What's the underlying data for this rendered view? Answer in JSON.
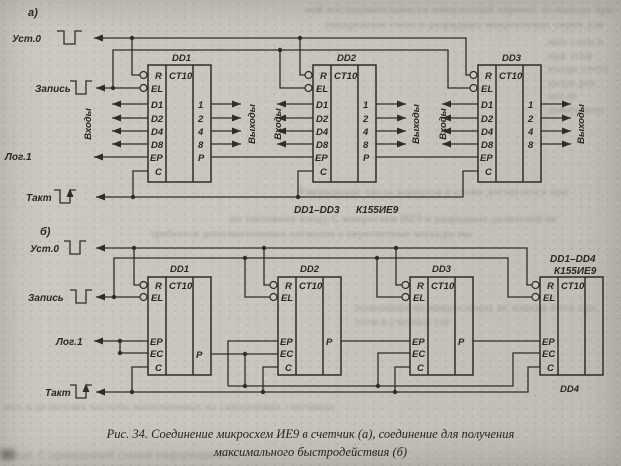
{
  "page": {
    "paper_color": "#c8c5be",
    "ink_color": "#2f2d29"
  },
  "diagram_a": {
    "label": "а)",
    "signals": {
      "set0": "Уст.0",
      "write": "Запись",
      "log1": "Лог.1",
      "clock": "Такт",
      "inputs": "Входы",
      "outputs": "Выходы"
    },
    "chips": [
      {
        "name": "DD1",
        "type": "CT10",
        "pins_left": [
          "R",
          "EL",
          "D1",
          "D2",
          "D4",
          "D8",
          "EP",
          "C"
        ],
        "pins_right": [
          "1",
          "2",
          "4",
          "8",
          "P"
        ]
      },
      {
        "name": "DD2",
        "type": "CT10",
        "pins_left": [
          "R",
          "EL",
          "D1",
          "D2",
          "D4",
          "D8",
          "EP",
          "C"
        ],
        "pins_right": [
          "1",
          "2",
          "4",
          "8",
          "P"
        ]
      },
      {
        "name": "DD3",
        "type": "CT10",
        "pins_left": [
          "R",
          "EL",
          "D1",
          "D2",
          "D4",
          "D8",
          "EP",
          "C"
        ],
        "pins_right": [
          "1",
          "2",
          "4",
          "8"
        ]
      }
    ],
    "part_label": "DD1–DD3",
    "part_number": "К155ИЕ9"
  },
  "diagram_b": {
    "label": "б)",
    "signals": {
      "set0": "Уст.0",
      "write": "Запись",
      "log1": "Лог.1",
      "clock": "Такт"
    },
    "chips": [
      {
        "name": "DD1",
        "type": "CT10",
        "pins_left": [
          "R",
          "EL",
          "EP",
          "EC",
          "C"
        ],
        "carry": "P"
      },
      {
        "name": "DD2",
        "type": "CT10",
        "pins_left": [
          "R",
          "EL",
          "EP",
          "EC",
          "C"
        ],
        "carry": "P"
      },
      {
        "name": "DD3",
        "type": "CT10",
        "pins_left": [
          "R",
          "EL",
          "EP",
          "EC",
          "C"
        ],
        "carry": "P"
      },
      {
        "name": "DD4",
        "type": "CT10",
        "pins_left": [
          "R",
          "EL",
          "EP",
          "EC",
          "C"
        ],
        "carry": ""
      }
    ],
    "part_label": "DD1–DD4",
    "part_number": "К155ИЕ9"
  },
  "caption": {
    "line1": "Рис. 34. Соединение микросхем ИЕ9 в счетчик (а), соединение для получения",
    "line2": "максимального быстродействия (б)"
  },
  "bleed": [
    "ной последовательности импульсный перенос на выходе при",
    "синхронном счете и разрядных микросхемах серии для всех",
    "ных схем и при этом входы счета разря дов после довательно",
    "Уменьшение числа корпусов в схеме достигается при соединении",
    "по тактовому входу С микросхем ИЕ9 и разрядных делителей не",
    "требуется дополнительных сигналов а пересчетные каскады вы",
    "полненные на микросхемах не изменя ются при этом в счетных схе",
    "мах и делителях частоты выполненных на синхронных счетчиках",
    "входе. С приведенной схемой информацией со входов"
  ]
}
